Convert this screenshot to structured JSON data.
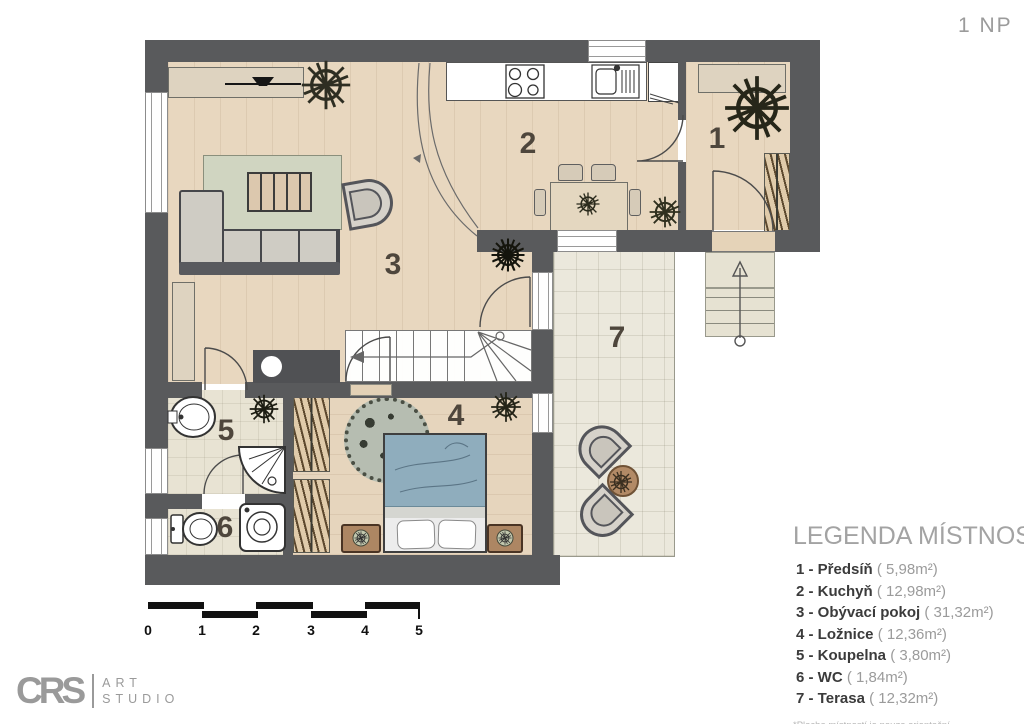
{
  "header": {
    "floor_label": "1 NP"
  },
  "plan": {
    "room_numbers": {
      "r1": "1",
      "r2": "2",
      "r3": "3",
      "r4": "4",
      "r5": "5",
      "r6": "6",
      "r7": "7"
    }
  },
  "legend": {
    "title": "LEGENDA MÍSTNOSTÍ",
    "items": [
      {
        "label": "1 - Předsíň",
        "area": "( 5,98m²)"
      },
      {
        "label": "2 - Kuchyň",
        "area": "( 12,98m²)"
      },
      {
        "label": "3 - Obývací pokoj",
        "area": "( 31,32m²)"
      },
      {
        "label": "4 - Ložnice",
        "area": "( 12,36m²)"
      },
      {
        "label": "5 - Koupelna",
        "area": "( 3,80m²)"
      },
      {
        "label": "6 - WC",
        "area": "( 1,84m²)"
      },
      {
        "label": "7 - Terasa",
        "area": "( 12,32m²)"
      }
    ],
    "footnote": "*Plocha místností je pouze orientační"
  },
  "scale_bar": {
    "labels": [
      "0",
      "1",
      "2",
      "3",
      "4",
      "5"
    ]
  },
  "logo": {
    "monogram": "CRS",
    "line1": "ART",
    "line2": "STUDIO"
  },
  "colors": {
    "wall": "#595a5c",
    "wood": "#e8d7bf",
    "tile": "#e8e3d3",
    "terrace": "#ebe8dc",
    "bed_blanket": "#8fadbd"
  }
}
